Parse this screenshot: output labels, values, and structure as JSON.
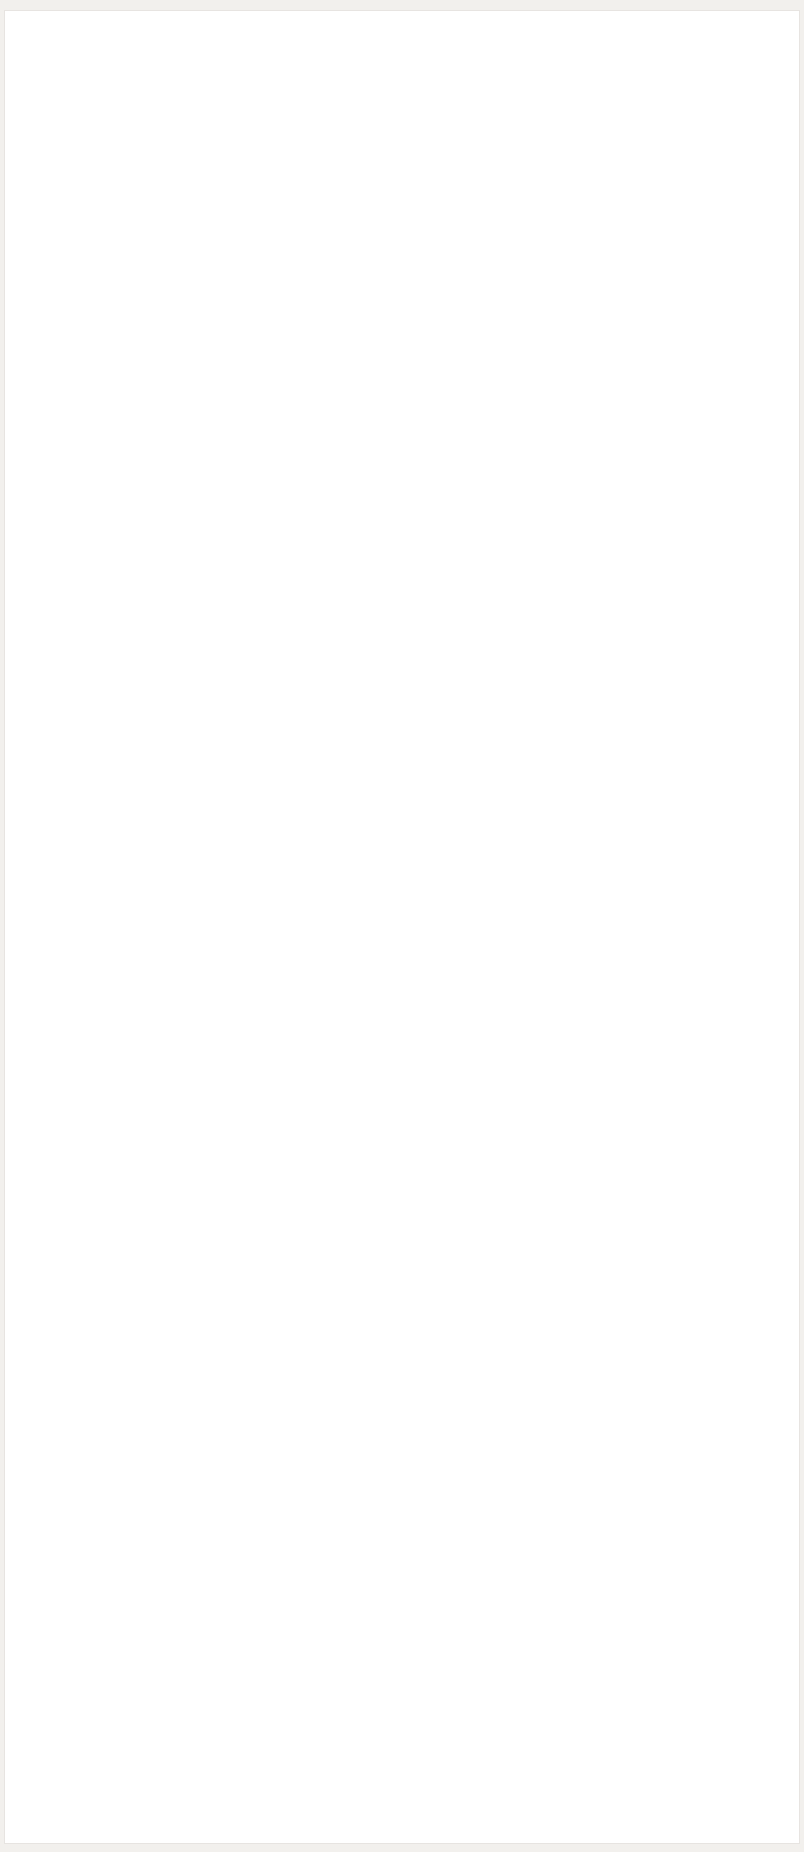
{
  "front_view": {
    "span_label": "2780 мм",
    "height_label": "3602 мм",
    "lift_range_label": "1817-1922 мм",
    "pad_height_label": "89-197 мм"
  },
  "top_view": {
    "arm_reach_label": "683-1195 мм",
    "drive_through_label": "2554 мм",
    "overall_width_label": "3390 мм"
  }
}
